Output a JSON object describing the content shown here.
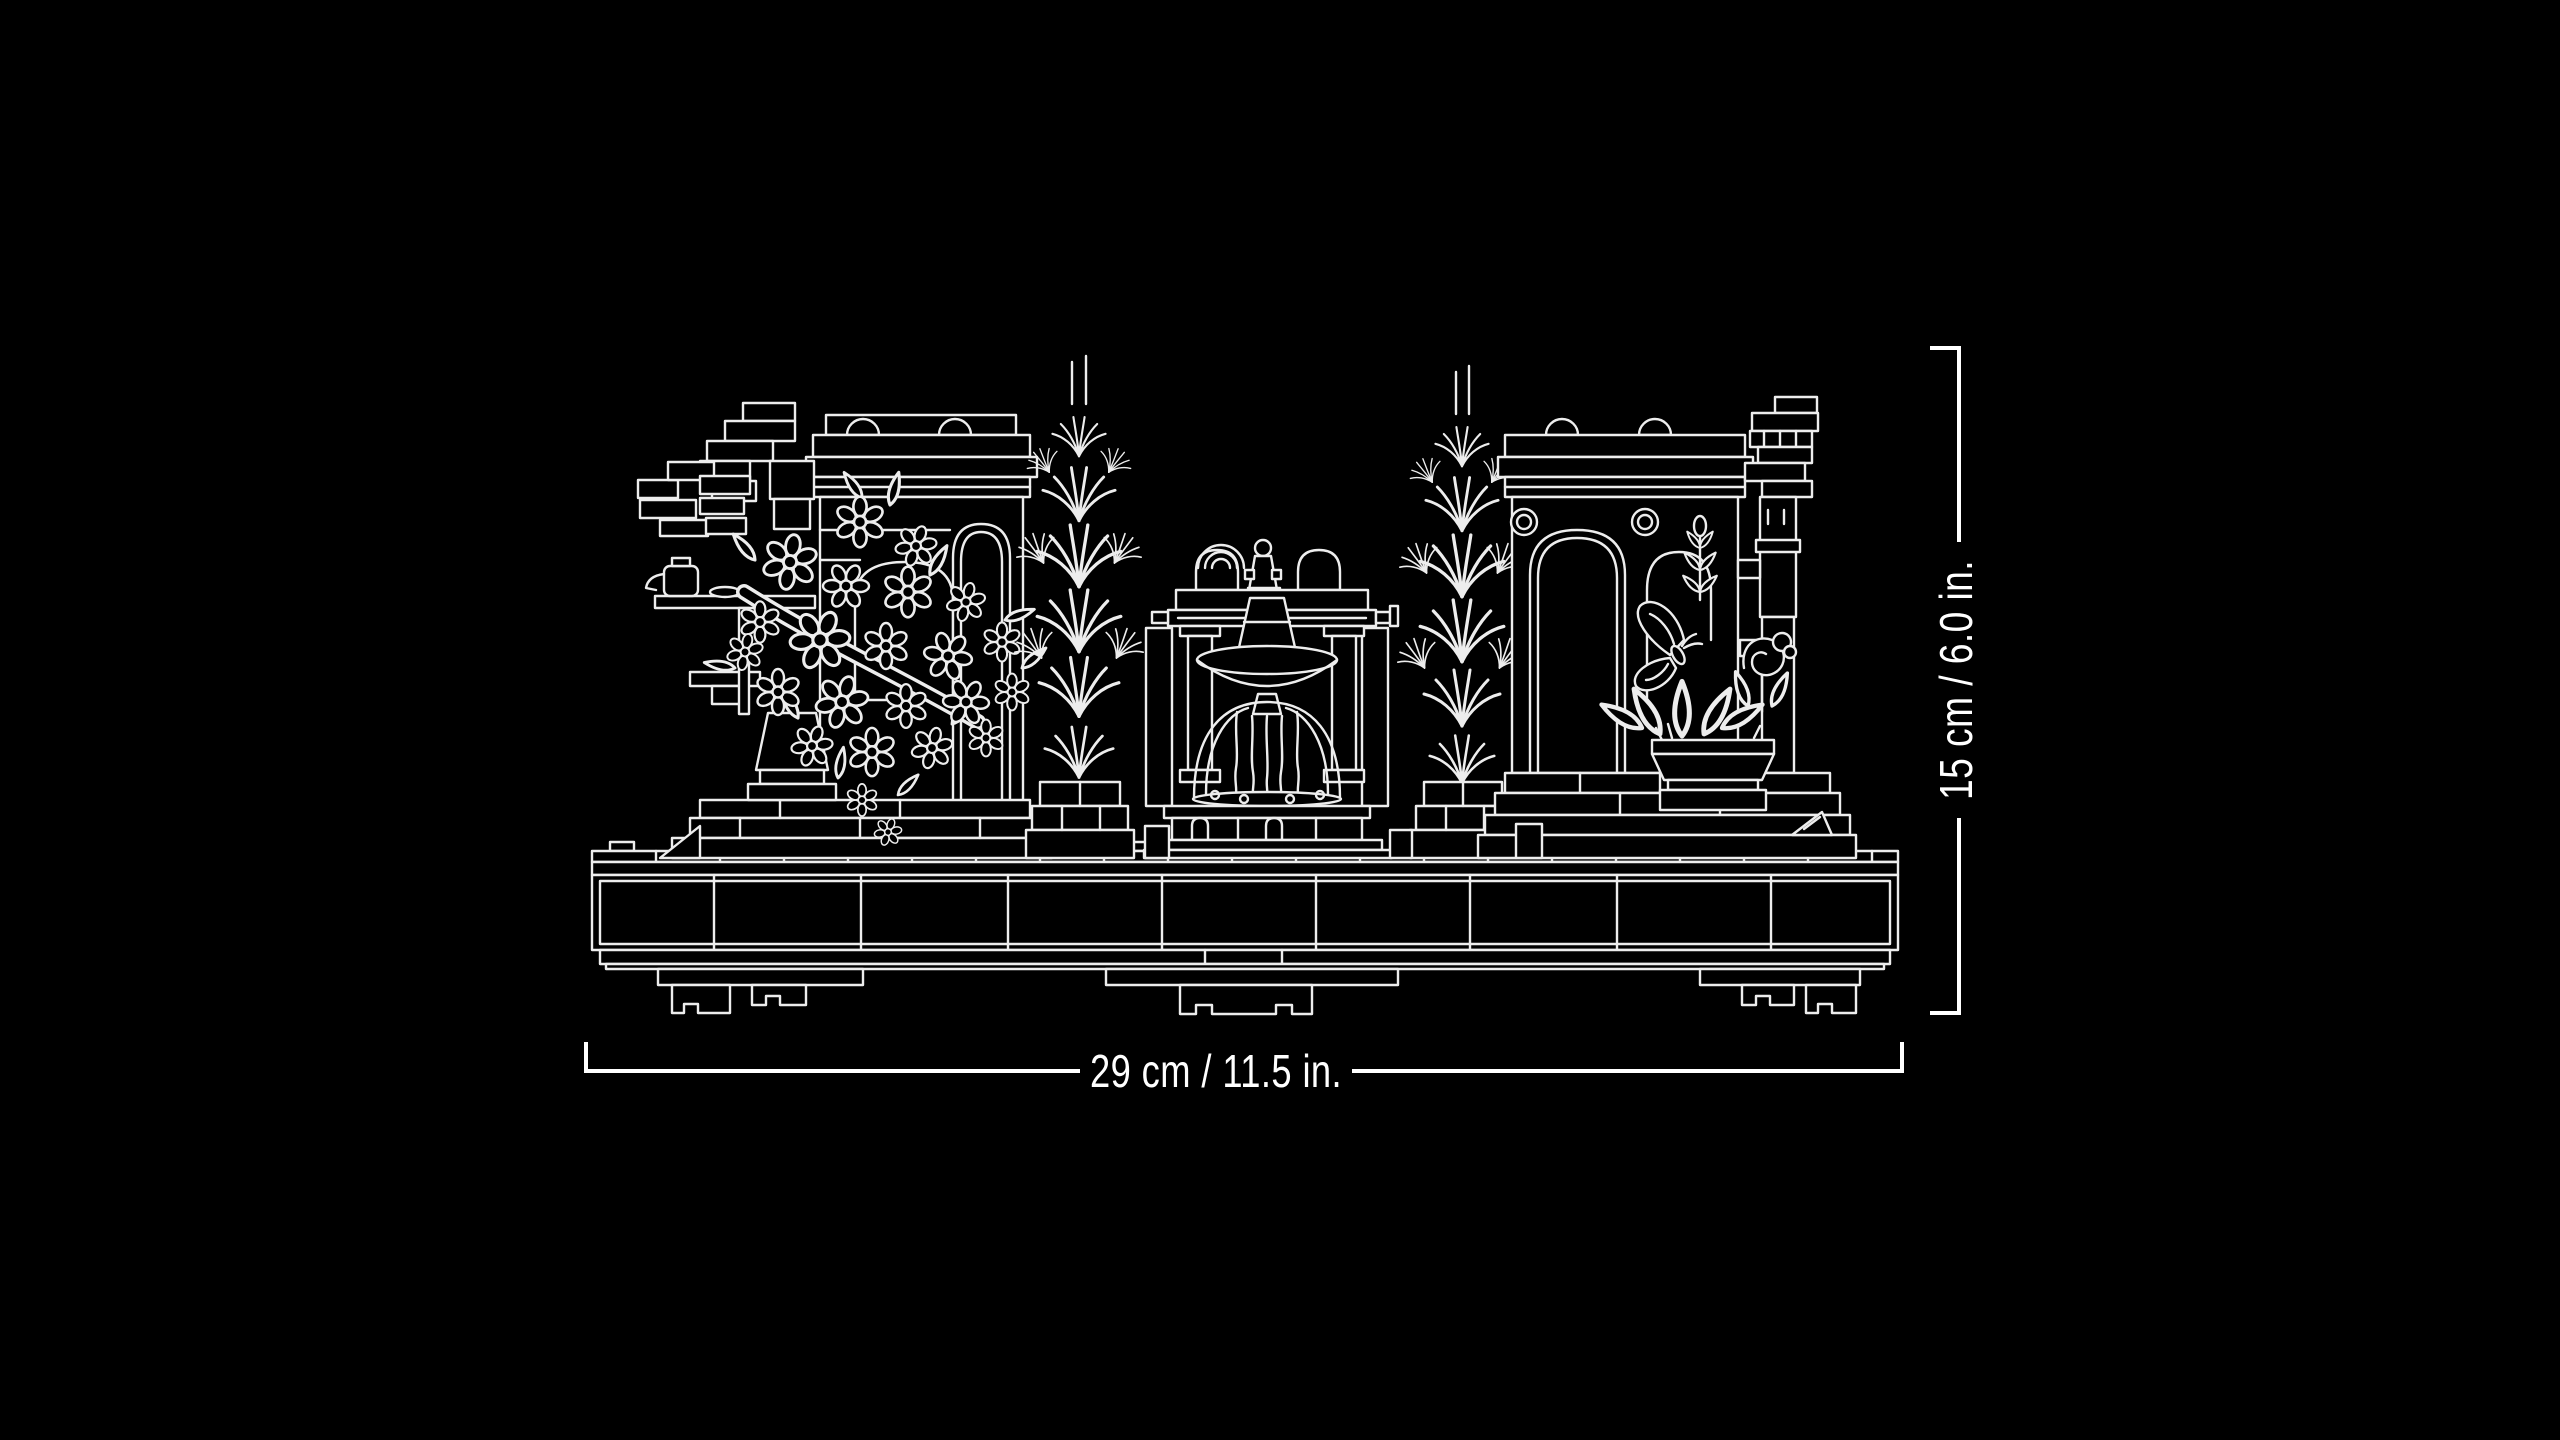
{
  "page": {
    "background_color": "#000000",
    "drawing_color": "#ededed",
    "description": "White outline (blueprint style) drawing of a LEGO garden-ruins diorama: broken walls with arches, a flowering vine, two cypress trees, a central fountain with falling water, a potted plant with a butterfly, all on a studded brick base."
  },
  "dimensions": {
    "width_label": "29 cm / 11.5 in.",
    "height_label": "15 cm / 6.0 in."
  }
}
